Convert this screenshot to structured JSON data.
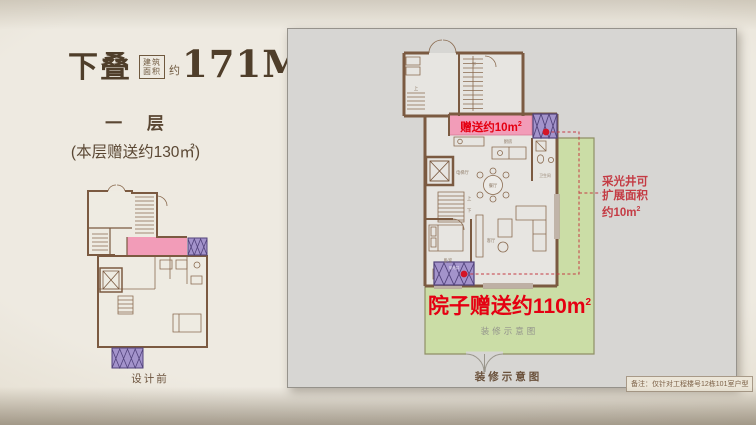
{
  "header": {
    "title": "下叠",
    "area_box_line1": "建筑",
    "area_box_line2": "面积",
    "area_approx": "约",
    "area_value": "171M",
    "area_sup": "2",
    "floor_label": "一 层",
    "bonus_label": "(本层赠送约130㎡)"
  },
  "before_plan": {
    "caption": "设计前"
  },
  "plan": {
    "gift": {
      "text": "赠送约10m",
      "sup": "2"
    },
    "lightwell_note": {
      "line1": "采光井可",
      "line2": "扩展面积",
      "line3": "约10m",
      "sup": "2"
    },
    "yard": {
      "text": "院子赠送约110m",
      "sup": "2",
      "subtitle": "装修示意图"
    },
    "caption": "装修示意图",
    "note": "备注：仅针对工程楼号12栋101室户型",
    "rooms": {
      "elevator": "电梯厅",
      "dining": "餐厅",
      "kitchen": "厨房",
      "bath": "卫生间",
      "living": "客厅",
      "bedroom": "卧室",
      "up": "上",
      "down": "下",
      "lightwell": "采光井"
    }
  },
  "colors": {
    "accent_red": "#e50012",
    "annotation_red": "#c43b44",
    "pink": "#f29cb8",
    "purple": "#a393cb",
    "yard_green": "#cbdda6",
    "wall_brown": "#7b5a41",
    "title_brown": "#4f3e2a",
    "panel_gray": "#d7d6d3"
  }
}
